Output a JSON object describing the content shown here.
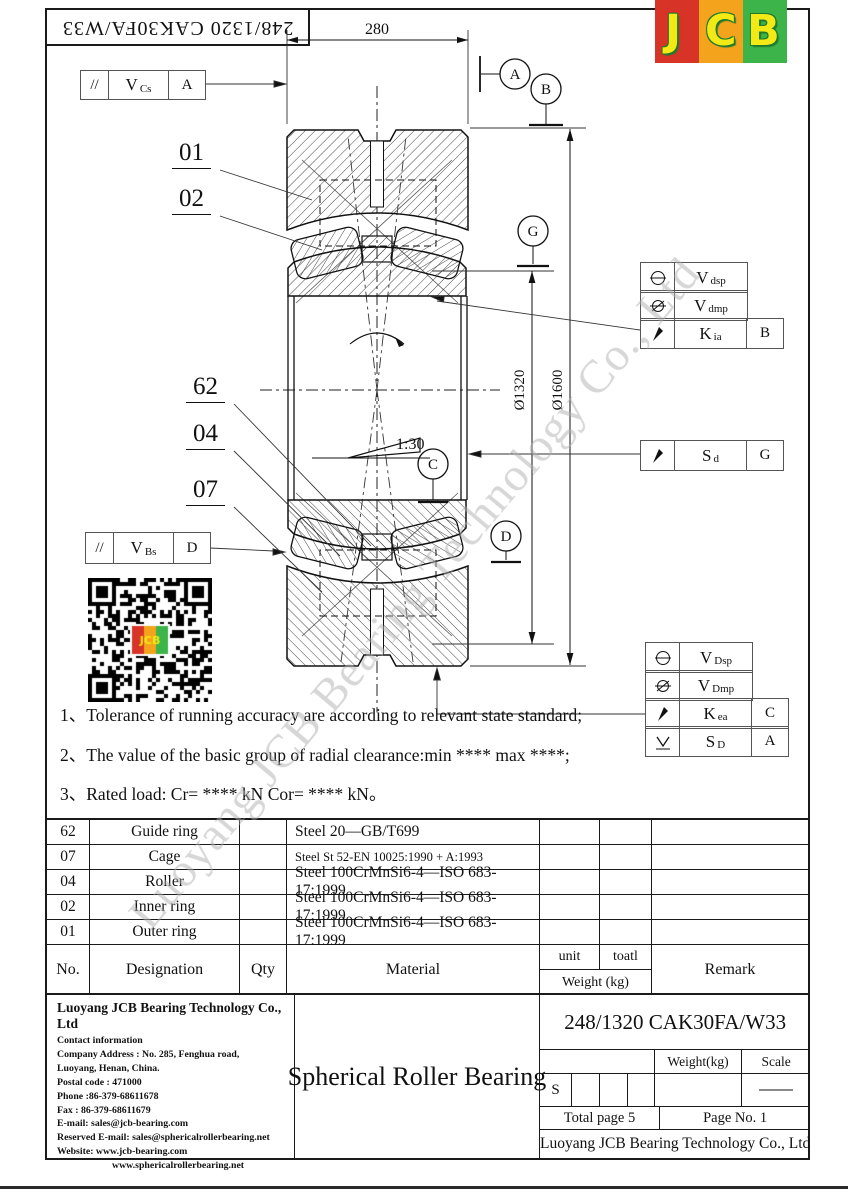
{
  "header": {
    "part_number_top": "248/1320 CAK30FA/W33",
    "logo_letters": {
      "l1": "J",
      "l2": "C",
      "l3": "B"
    }
  },
  "colors": {
    "logo_red": "#d73327",
    "logo_orange": "#f4a31c",
    "logo_green": "#3cb449",
    "logo_letter": "#f3ea15",
    "line": "#1a1a1a",
    "watermark": "#b0b0b0"
  },
  "drawing": {
    "dim_width": "280",
    "dim_inner": "Ø1320",
    "dim_outer": "Ø1600",
    "taper_label": "1:30",
    "balloons": {
      "b01": "01",
      "b02": "02",
      "b62": "62",
      "b04": "04",
      "b07": "07"
    },
    "datum_circles": {
      "a": "A",
      "b": "B",
      "g": "G",
      "c": "C",
      "d": "D"
    },
    "frame_vcs": {
      "sym": "//",
      "main": "V",
      "sub": "Cs",
      "datum": "A"
    },
    "frame_vbs": {
      "sym": "//",
      "main": "V",
      "sub": "Bs",
      "datum": "D"
    },
    "frame_right_top": {
      "rows": [
        {
          "icon": "circle-line",
          "main": "V",
          "sub": "dsp",
          "datum": ""
        },
        {
          "icon": "circle-slash",
          "main": "V",
          "sub": "dmp",
          "datum": ""
        },
        {
          "icon": "runout-arrow",
          "main": "K",
          "sub": "ia",
          "datum": "B"
        }
      ]
    },
    "frame_sd": {
      "icon": "runout-arrow",
      "main": "S",
      "sub": "d",
      "datum": "G"
    },
    "frame_right_bottom": {
      "rows": [
        {
          "icon": "circle-line",
          "main": "V",
          "sub": "Dsp",
          "datum": ""
        },
        {
          "icon": "circle-slash",
          "main": "V",
          "sub": "Dmp",
          "datum": ""
        },
        {
          "icon": "runout-arrow",
          "main": "K",
          "sub": "ea",
          "datum": "C"
        },
        {
          "icon": "vee-line",
          "main": "S",
          "sub": "D",
          "datum": "A"
        }
      ]
    }
  },
  "notes": [
    "1、Tolerance of running accuracy are according to relevant state standard;",
    "2、The value of the basic group of radial clearance:min **** max ****;",
    "3、Rated load: Cr= **** kN Cor= **** kN。"
  ],
  "parts_table": {
    "header": {
      "no": "No.",
      "designation": "Designation",
      "qty": "Qty",
      "material": "Material",
      "unit": "unit",
      "total": "toatl",
      "weight": "Weight (kg)",
      "remark": "Remark"
    },
    "rows": [
      {
        "no": "62",
        "designation": "Guide ring",
        "qty": "",
        "material": "Steel 20—GB/T699",
        "unit": "",
        "total": "",
        "remark": ""
      },
      {
        "no": "07",
        "designation": "Cage",
        "qty": "",
        "material": "Steel St 52-EN 10025:1990 + A:1993",
        "unit": "",
        "total": "",
        "remark": ""
      },
      {
        "no": "04",
        "designation": "Roller",
        "qty": "",
        "material": "Steel 100CrMnSi6-4—ISO 683-17:1999",
        "unit": "",
        "total": "",
        "remark": ""
      },
      {
        "no": "02",
        "designation": "Inner ring",
        "qty": "",
        "material": "Steel 100CrMnSi6-4—ISO 683-17:1999",
        "unit": "",
        "total": "",
        "remark": ""
      },
      {
        "no": "01",
        "designation": "Outer ring",
        "qty": "",
        "material": "Steel 100CrMnSi6-4—ISO 683-17:1999",
        "unit": "",
        "total": "",
        "remark": ""
      }
    ]
  },
  "title_block": {
    "company_name": "Luoyang JCB Bearing Technology Co., Ltd",
    "contact_lines": [
      "Contact information",
      "Company Address : No. 285, Fenghua road,",
      "Luoyang, Henan, China.",
      "Postal code : 471000",
      "Phone :86-379-68611678",
      "Fax :  86-379-68611679",
      "E-mail: sales@jcb-bearing.com",
      "Reserved E-mail: sales@sphericalrollerbearing.net",
      "Website: www.jcb-bearing.com",
      "www.sphericalrollerbearing.net"
    ],
    "product_name": "Spherical Roller Bearing",
    "part_number": "248/1320 CAK30FA/W33",
    "weight_label": "Weight(kg)",
    "scale_label": "Scale",
    "s_label": "S",
    "total_page": "Total page 5",
    "page_no": "Page No.  1",
    "footer_company": "Luoyang JCB Bearing Technology Co., Ltd"
  },
  "watermark": "Luoyang JCB Bearing Technology Co., Ltd"
}
